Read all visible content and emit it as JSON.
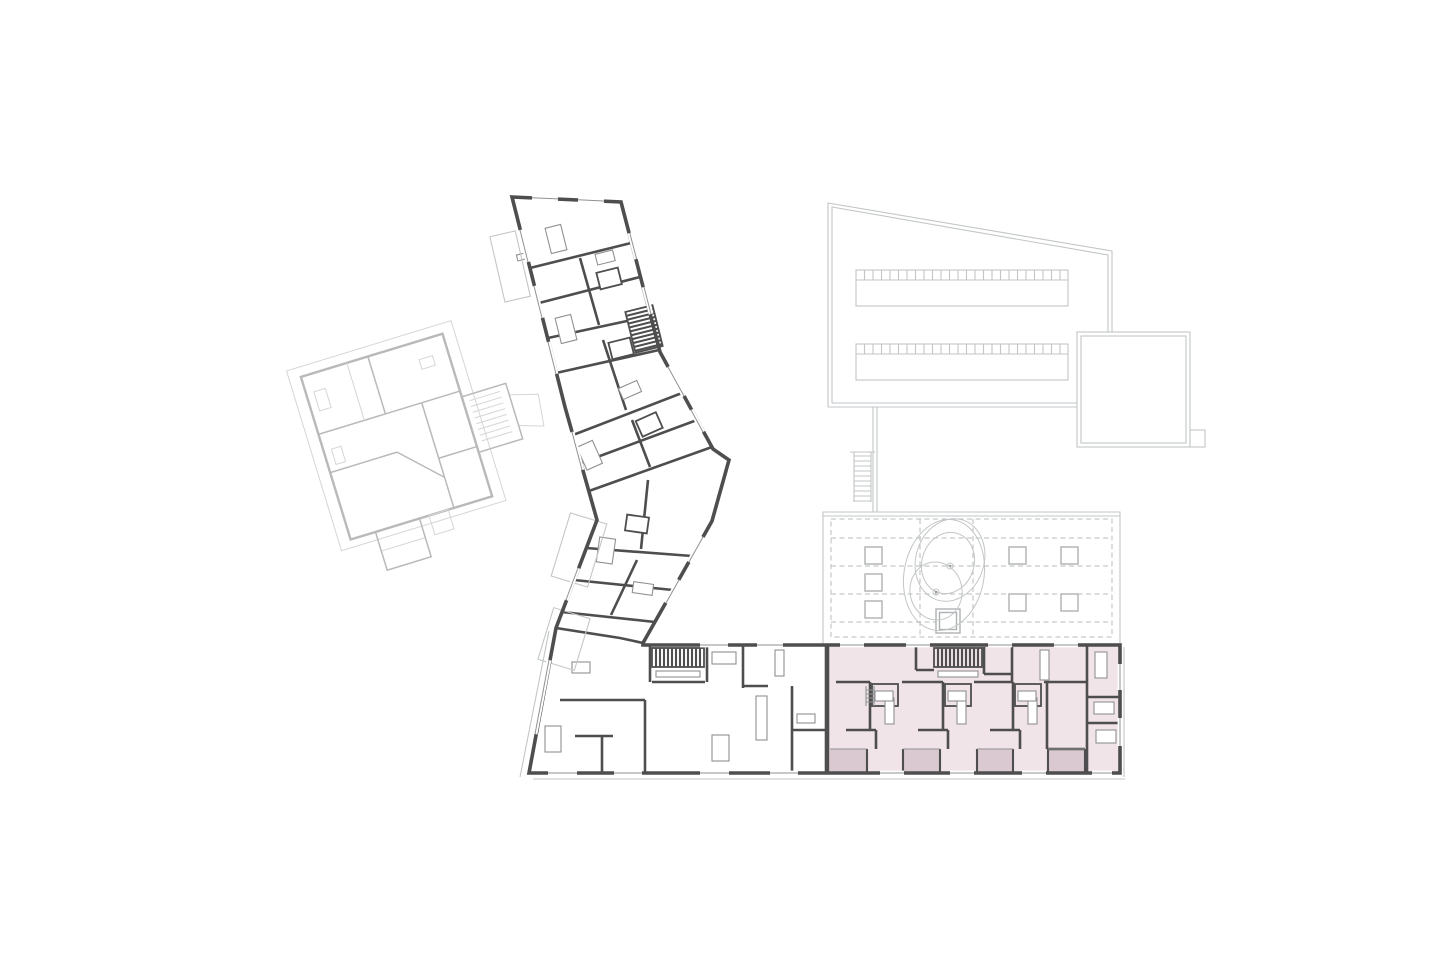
{
  "meta": {
    "artifact": "architectural-floor-plan",
    "page_background": "#ffffff",
    "no_visible_text": true
  },
  "colors": {
    "page_background": "#ffffff",
    "room_fill": "#ffffff",
    "wall_dark": "#4e4e4e",
    "line_medium": "#8f9193",
    "line_light": "#c3c6c7",
    "ghost_wall": "#abadae",
    "ghost_line": "#cdcfd0",
    "dashed_line": "#b8bcbd",
    "skylight_line": "#aeb1b2",
    "highlight_fill": "#f1e4e9",
    "highlight_balcony": "#dbc9d2"
  },
  "plan": {
    "sections": [
      {
        "id": "existing-building",
        "role": "faded-context-building",
        "rotated": true
      },
      {
        "id": "apartment-wing",
        "role": "angled-residential-wing",
        "stair_symbols": 1
      },
      {
        "id": "base-bar",
        "role": "lower-residential-bar",
        "stair_symbols": 1
      },
      {
        "id": "highlighted-unit",
        "role": "selected-dwelling-section",
        "fill": "#f1e4e9",
        "balcony_fill": "#dbc9d2",
        "balcony_count": 4,
        "stair_symbols": 1
      },
      {
        "id": "hall-building",
        "role": "adjacent-hall-outline",
        "skylight_strips": 2,
        "cells_per_strip": 25
      },
      {
        "id": "roof-courtyard",
        "role": "deck-with-skylights-and-trees",
        "skylight_squares": 8,
        "tree_symbols": 2,
        "ladder_symbols": 1
      }
    ]
  }
}
